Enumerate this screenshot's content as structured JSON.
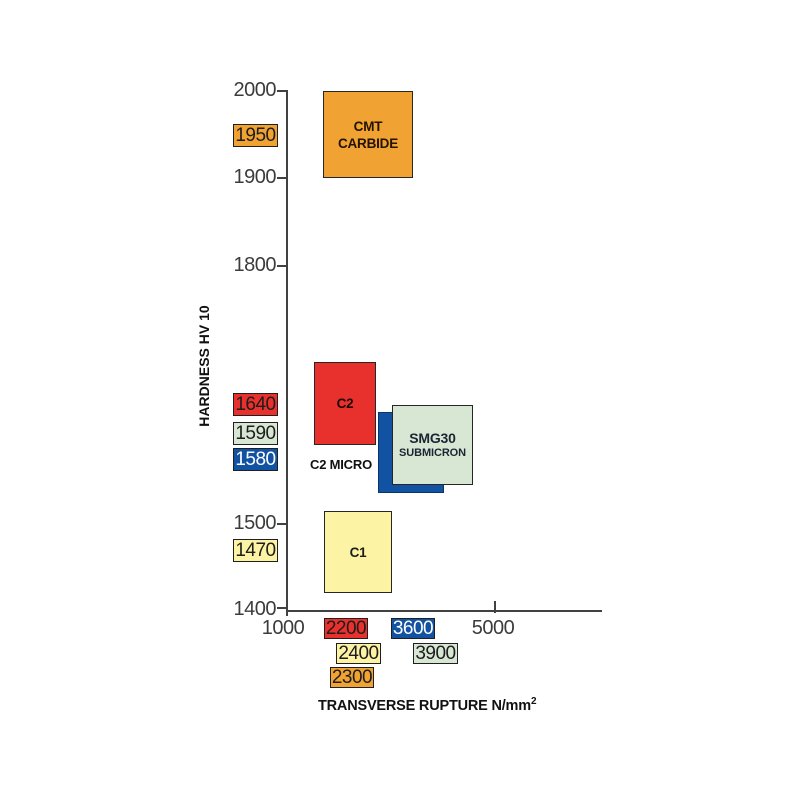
{
  "chart_data": {
    "type": "scatter",
    "variant": "labeled-property-range-boxes",
    "title": "",
    "xlabel": "TRANSVERSE RUPTURE N/mm²",
    "xlabel_base": "TRANSVERSE RUPTURE N/mm",
    "xlabel_sup": "2",
    "ylabel": "HARDNESS HV 10",
    "xlim": [
      1000,
      7000
    ],
    "ylim": [
      1400,
      2000
    ],
    "x_ticks": [
      1000,
      5000
    ],
    "y_ticks": [
      2000,
      1900,
      1800,
      1500,
      1400
    ],
    "grid": false,
    "legend_position": "none",
    "axis_color": "#414141",
    "series": [
      {
        "name": "CMT CARBIDE",
        "label_lines": [
          "CMT",
          "CARBIDE"
        ],
        "color": "#f0a233",
        "hardness_hv10": 1950,
        "transverse_rupture_n_mm2": 2300,
        "hv_range": [
          1900,
          2000
        ],
        "trs_range": [
          1700,
          3400
        ]
      },
      {
        "name": "C2",
        "label_lines": [
          "C2"
        ],
        "color": "#e8312c",
        "hardness_hv10": 1640,
        "transverse_rupture_n_mm2": 2200,
        "hv_range": [
          1590,
          1690
        ],
        "trs_range": [
          1520,
          2690
        ]
      },
      {
        "name": "C2 MICRO",
        "label_lines": [
          "C2 MICRO"
        ],
        "color": "#1152a3",
        "hardness_hv10": 1580,
        "transverse_rupture_n_mm2": 3600,
        "hv_range": [
          1535,
          1630
        ],
        "trs_range": [
          2750,
          4020
        ]
      },
      {
        "name": "SMG30 SUBMICRON",
        "label_lines": [
          "SMG30",
          "SUBMICRON"
        ],
        "color": "#d8e7d3",
        "hardness_hv10": 1590,
        "transverse_rupture_n_mm2": 3900,
        "hv_range": [
          1545,
          1635
        ],
        "trs_range": [
          3020,
          4580
        ]
      },
      {
        "name": "C1",
        "label_lines": [
          "C1"
        ],
        "color": "#fcf3a5",
        "hardness_hv10": 1470,
        "transverse_rupture_n_mm2": 2400,
        "hv_range": [
          1420,
          1515
        ],
        "trs_range": [
          1710,
          3020
        ]
      }
    ]
  }
}
